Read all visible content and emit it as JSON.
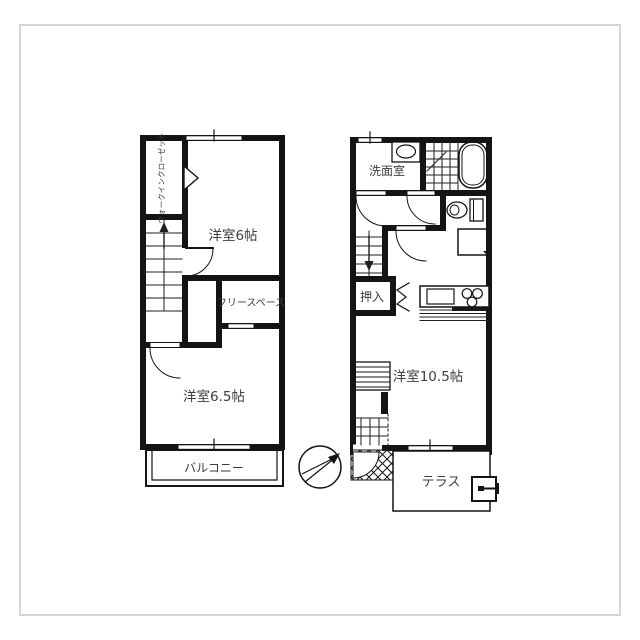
{
  "colors": {
    "wall": "#141414",
    "thin_line": "#1f1f1f",
    "text": "#3e3e3e",
    "frame": "#c8c8c8",
    "background": "#ffffff"
  },
  "plan_2f": {
    "labels": {
      "walk_in_closet": "ウォークインクローゼット",
      "western_room_6": "洋室6帖",
      "free_space": "フリースペース",
      "western_room_6_5": "洋室6.5帖",
      "balcony": "バルコニー"
    }
  },
  "plan_1f": {
    "labels": {
      "washroom": "洗面室",
      "closet": "押入",
      "western_room_10_5": "洋室10.5帖",
      "terrace": "テラス"
    }
  }
}
